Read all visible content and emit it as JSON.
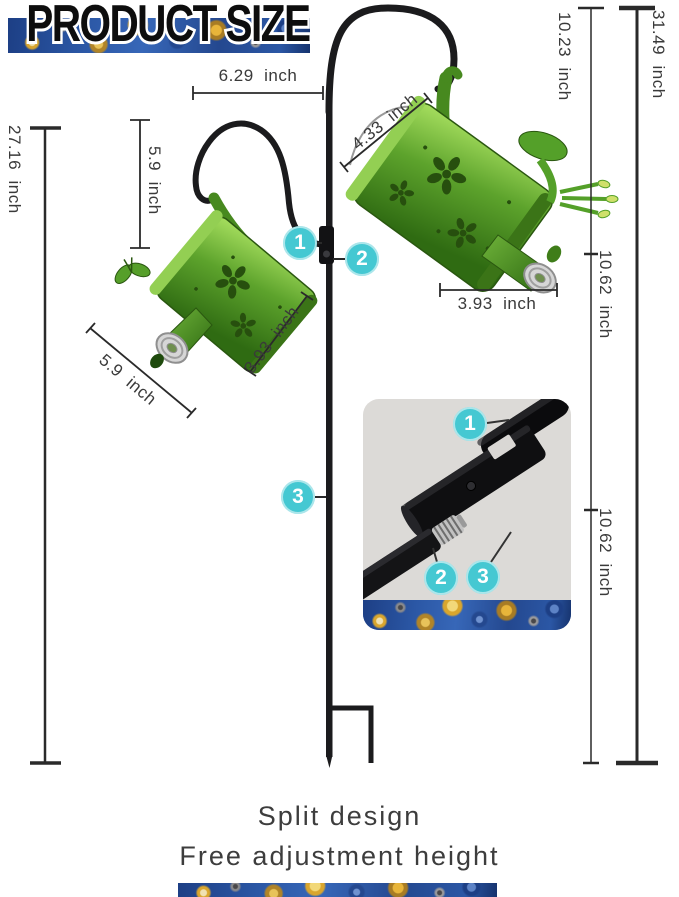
{
  "title": "PRODUCT SIZE",
  "dims": {
    "pole_offset": "6.29  inch",
    "upper_section": "10.23  inch",
    "total_height": "31.49  inch",
    "stand_height": "27.16  inch",
    "hang_drop": "5.9  inch",
    "handle_arc": "4.33  inch",
    "left_can_width": "3.93  inch",
    "left_can_length": "5.9  inch",
    "right_can_width": "3.93  inch",
    "middle_section": "10.62  inch",
    "lower_section": "10.62  inch"
  },
  "markers": {
    "m1": "1",
    "m2": "2",
    "m3": "3"
  },
  "inset_markers": {
    "m1": "1",
    "m2": "2",
    "m3": "3"
  },
  "footer": {
    "line1": "Split design",
    "line2": "Free adjustment height"
  },
  "colors": {
    "accent_teal": "#45c8d2",
    "can_green": "#58a427",
    "pole_black": "#1b1b1d",
    "strip_blue": "#2b57a5"
  }
}
